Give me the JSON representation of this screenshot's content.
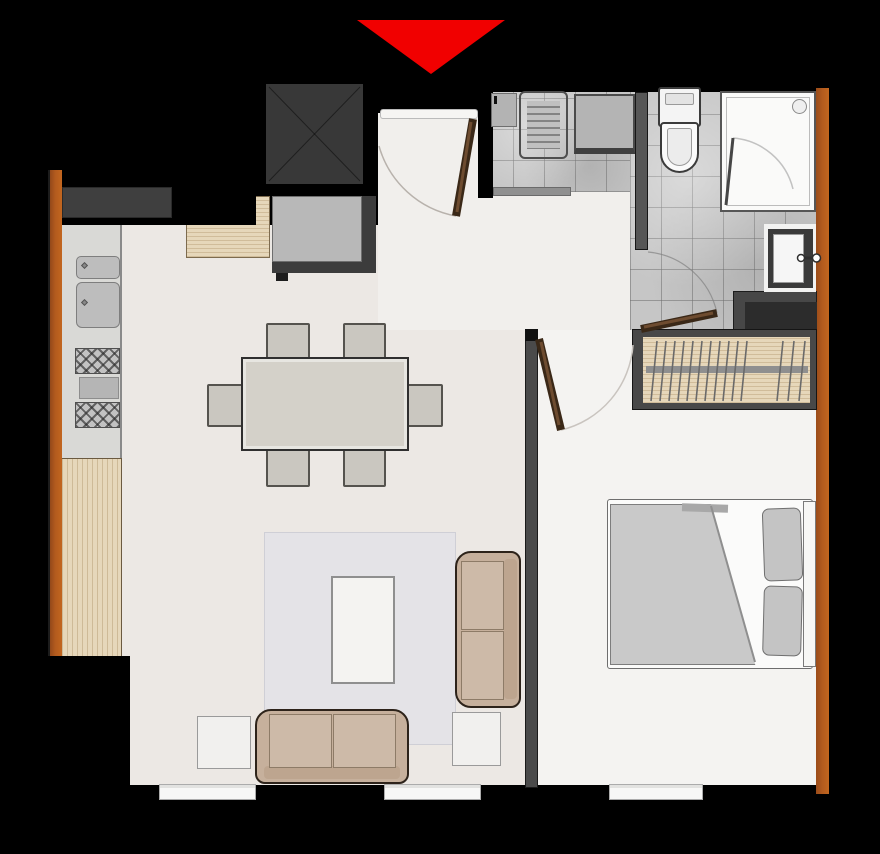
{
  "diagram": {
    "type": "apartment-unit-floor-plan",
    "entrance_marker": "red triangle pointing down at main entrance",
    "window_count": 3,
    "rooms": [
      {
        "name": "kitchen-living-dining",
        "items": [
          "range-hood",
          "kitchen-counter",
          "double-sink",
          "four-burner-stove",
          "wood-counter",
          "entry-console",
          "refrigerator",
          "dining-table",
          "six-dining-chairs",
          "rug",
          "coffee-table",
          "two-seat-sofa",
          "corner-sofa",
          "two-side-tables"
        ]
      },
      {
        "name": "bathroom-laundry",
        "items": [
          "washing-machine",
          "utility-counter",
          "toilet",
          "shower-enclosure",
          "washbasin",
          "vanity-shelf",
          "tiled-floor"
        ]
      },
      {
        "name": "bedroom",
        "items": [
          "double-bed",
          "duvet",
          "two-pillows",
          "headboard",
          "wardrobe-with-hangers"
        ]
      }
    ],
    "doors": [
      "entry-swing-door",
      "bedroom-swing-door",
      "bathroom-swing-door",
      "shower-glass-door"
    ]
  },
  "colors": {
    "bg": "#000000",
    "red": "#f10000",
    "orange": "#b35b1e",
    "wallgrey": "#4a4a4a",
    "divider": "#565656",
    "floor": "#ece8e4",
    "floor2": "#f1efec",
    "bedfloor": "#f4f3f1",
    "tile": "#c6c6c6",
    "counter": "#d9d9d6",
    "wood": "#e6d7ba",
    "dark": "#3c3c3c",
    "appliance": "#b8b8b8",
    "white": "#fbfbfa",
    "beige": "#c6b09c",
    "cushion": "#cdbaa8",
    "beigeline": "#2d231a",
    "rug": "#e4e3e7",
    "tablegrey": "#d4d1c9",
    "chairgrey": "#cac7c0",
    "duvet": "#c9c9c9",
    "pillow": "#c4c4c4",
    "doorbrown": "#3a2817",
    "doorbrown2": "#6e4c30"
  }
}
